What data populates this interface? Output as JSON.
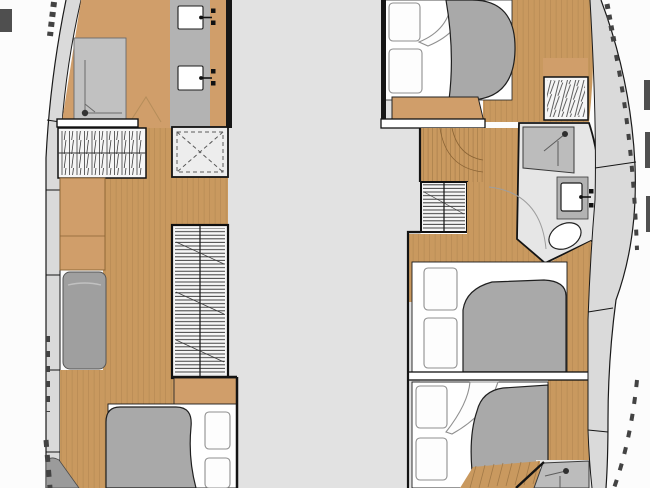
{
  "meta": {
    "title": "catamaran-interior-floorplan",
    "view": "top-down deck plan, two hulls with central bridge deck"
  },
  "colors": {
    "background": "#fcfcfc",
    "deck": "#e2e2e2",
    "side_deck": "#dadada",
    "wood_furniture": "#d09e6a",
    "wood_floor": "#c9995f",
    "wall_dark": "#161616",
    "white": "#ffffff",
    "off_white": "#f6f6f6",
    "counter_gray": "#b3b3b3",
    "shower_gray": "#c1c1c1",
    "shower_gray_dark": "#bcbcbc",
    "duvet_gray": "#a9a9a9",
    "seat_gray": "#9f9f9f",
    "hatch_fill": "#ededed",
    "bath_floor": "#e6e6e6",
    "tick_dark": "#4a4a4a",
    "corner_wedge": "#9b9b9b"
  },
  "legend": {
    "port_hull_fixtures": [
      "shower",
      "twin-washbasins",
      "hanging-locker",
      "storage-cabinets",
      "seat",
      "deck-hatch",
      "companionway-stairs",
      "double-berth-aft"
    ],
    "starboard_hull_fixtures": [
      "double-berth-forward",
      "hanging-locker",
      "entry-steps",
      "companionway-stairs",
      "shower",
      "washbasin",
      "toilet",
      "double-berth-mid",
      "double-berth-aft",
      "aft-shower"
    ]
  }
}
